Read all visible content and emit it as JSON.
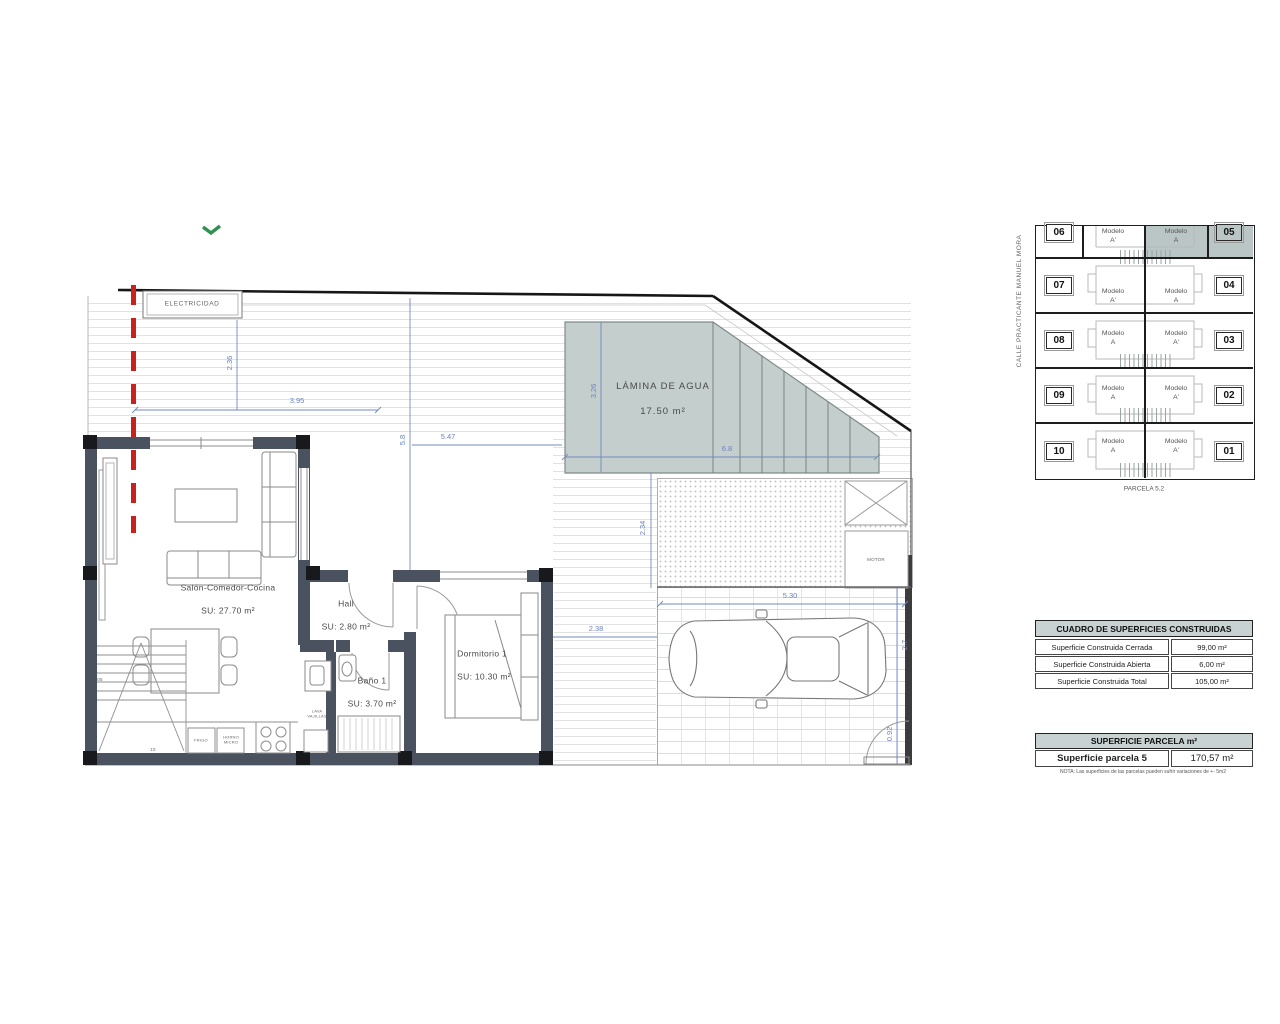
{
  "floorplan": {
    "electricidad": "ELECTRICIDAD",
    "rooms": {
      "salon_name": "Salón-Comedor-Cocina",
      "salon_area": "SU: 27.70 m²",
      "hall_name": "Hall",
      "hall_area": "SU: 2.80 m²",
      "bano_name": "Baño 1",
      "bano_area": "SU: 3.70 m²",
      "dorm_name": "Dormitorio 1",
      "dorm_area": "SU: 10.30 m²",
      "pool_name": "LÁMINA DE AGUA",
      "pool_area": "17.50 m²"
    },
    "labels": {
      "frigo": "FRIGO",
      "horno": "HORNO\nMICRO",
      "lava": "LAVA\nVAJILLAS",
      "motor": "MOTOR",
      "step_a": "05",
      "step_b": "10"
    },
    "dims": {
      "d236": "2.36",
      "d395": "3.95",
      "d58": "5.8",
      "d547": "5.47",
      "d326": "3.26",
      "d68": "6.8",
      "d234": "2.34",
      "d238": "2.38",
      "d530": "5.30",
      "d27": "2.7",
      "d092": "0.92"
    },
    "colors": {
      "wall": "#49525e",
      "pool": "#c4cecd",
      "dimension": "#6c83c0",
      "boundary_red": "#c92020"
    }
  },
  "siteplan": {
    "street": "CALLE PRACTICANTE MANUEL MORA",
    "caption": "PARCELA 5.2",
    "highlight_color": "#b9c6c5",
    "rows": [
      {
        "num_left": "06",
        "model_left": "Modelo\nA'",
        "model_right": "Modelo\nA",
        "num_right": "05",
        "highlighted": true
      },
      {
        "num_left": "07",
        "model_left": "Modelo\nA'",
        "model_right": "Modelo\nA",
        "num_right": "04",
        "highlighted": false
      },
      {
        "num_left": "08",
        "model_left": "Modelo\nA",
        "model_right": "Modelo\nA'",
        "num_right": "03",
        "highlighted": false
      },
      {
        "num_left": "09",
        "model_left": "Modelo\nA",
        "model_right": "Modelo\nA'",
        "num_right": "02",
        "highlighted": false
      },
      {
        "num_left": "10",
        "model_left": "Modelo\nA",
        "model_right": "Modelo\nA'",
        "num_right": "01",
        "highlighted": false
      }
    ]
  },
  "surfaces_table": {
    "title": "CUADRO DE SUPERFICIES CONSTRUIDAS",
    "rows": [
      {
        "label": "Superficie Construida Cerrada",
        "value": "99,00 m²"
      },
      {
        "label": "Superficie Construida Abierta",
        "value": "6,00 m²"
      },
      {
        "label": "Superficie Construida Total",
        "value": "105,00 m²"
      }
    ]
  },
  "parcel_table": {
    "title": "SUPERFICIE PARCELA m²",
    "row_label": "Superficie parcela 5",
    "row_value": "170,57 m²",
    "note": "NOTA: Las superficies de las parcelas pueden sufrir variaciones de +- 5m2"
  }
}
